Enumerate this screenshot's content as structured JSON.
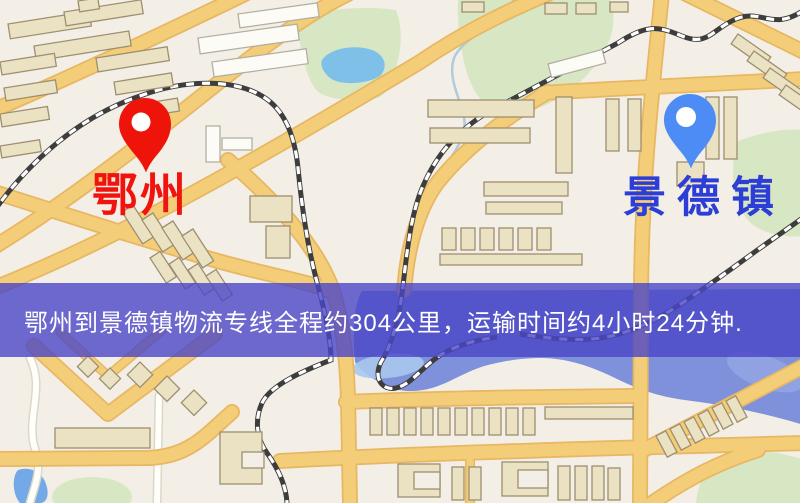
{
  "map": {
    "markers": [
      {
        "id": "origin",
        "label": "鄂州",
        "pin_color": "#ee1409",
        "label_color": "#f1130e"
      },
      {
        "id": "destination",
        "label": "景德镇",
        "pin_color": "#4e8cf5",
        "label_color": "#2c3ed6"
      }
    ],
    "palette": {
      "background": "#f3efe6",
      "road_major": "#f4cd78",
      "road_minor": "#fffef8",
      "water": "#8091dc",
      "lake": "#7fc0e8",
      "pond": "#72a9e6",
      "park": "#d8e7c3",
      "building": "#ebe2c4",
      "railway": "#3d3d3d"
    }
  },
  "banner": {
    "text": "鄂州到景德镇物流专线全程约304公里，运输时间约4小时24分钟.",
    "bg_color": "#4a46c7",
    "text_color": "#ffffff"
  }
}
